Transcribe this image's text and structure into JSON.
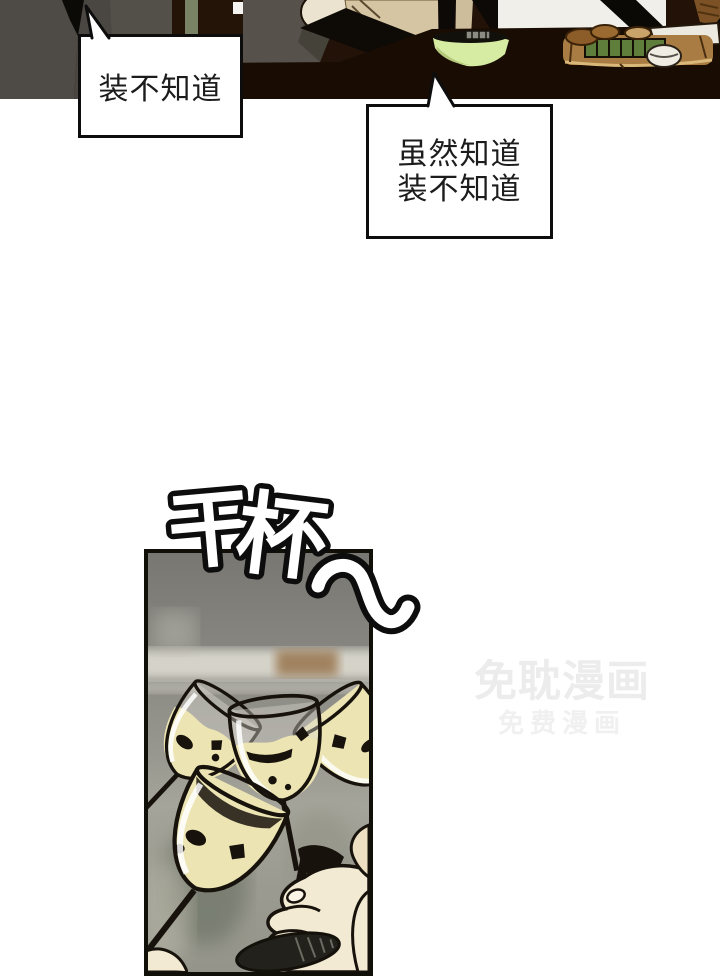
{
  "page": {
    "background": "#ffffff"
  },
  "speech_bubbles": {
    "bubble1": {
      "text": "装不知道"
    },
    "bubble2": {
      "lines": [
        "虽然知道",
        "装不知道"
      ]
    }
  },
  "sfx": {
    "text": "干杯",
    "chars": [
      "干",
      "杯"
    ]
  },
  "watermark": {
    "line1": "免耽漫画",
    "line2": "免费漫画",
    "color_primary": "#ececec",
    "color_secondary": "#f0f0f0"
  },
  "panels": {
    "dinner_scene": {
      "colors": {
        "table": "#190c03",
        "suit_grey": "#4e4a45",
        "figure_grey": "#56524b",
        "jacket_tan": "#d5c5a3",
        "bowl_green": "#d7eca3",
        "wall_white": "#f1efe9",
        "tray_wood": "#a87c42",
        "food_green": "#5f7d3b"
      }
    },
    "toast_scene": {
      "colors": {
        "background_grey": "#8b8a84",
        "wine": "#ece4b2",
        "hand": "#f2ead2",
        "outline": "#17130c"
      }
    }
  }
}
